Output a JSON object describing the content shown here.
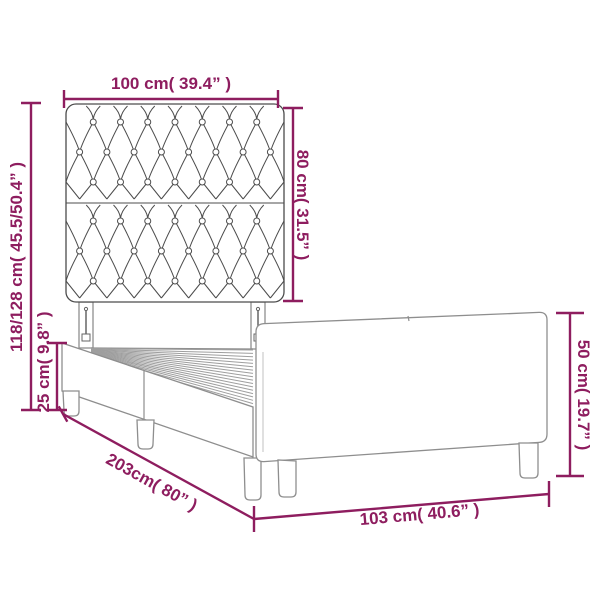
{
  "diagram": {
    "colors": {
      "dimension": "#8e1d5f",
      "headboard_outline": "#4c4c4c",
      "frame_outline": "#8e8e8e",
      "background": "#ffffff"
    },
    "dimensions": {
      "headboard_width": "100 cm( 39.4” )",
      "headboard_height": "80 cm( 31.5” )",
      "total_height": "118/128 cm( 45.5/50.4” )",
      "base_height": "25 cm( 9.8” )",
      "frame_length": "203cm( 80” )",
      "footboard_width": "103 cm( 40.6” )",
      "footboard_height": "50 cm( 19.7” )"
    }
  }
}
